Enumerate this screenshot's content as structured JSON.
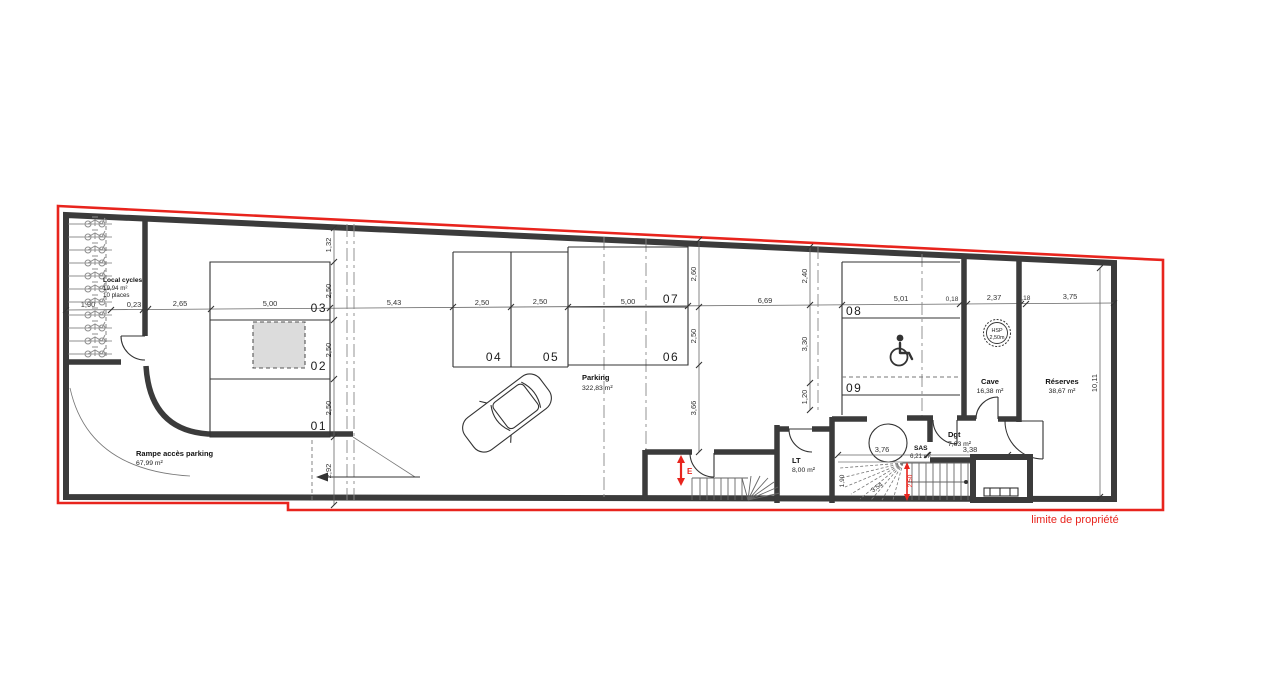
{
  "colors": {
    "wall": "#3b3b3b",
    "boundary": "#e8241d",
    "pillar": "#dcdcdc"
  },
  "boundary": {
    "label": "limite de propriété"
  },
  "markers": {
    "entrance": "E"
  },
  "hsp": {
    "line1": "HSP",
    "line2": "2,50m"
  },
  "rooms": {
    "local_cycles": {
      "name": "Local cycles",
      "area": "19,94 m²",
      "capacity": "10 places"
    },
    "parking": {
      "name": "Parking",
      "area": "322,83 m²"
    },
    "ramp": {
      "name": "Rampe accès parking",
      "area": "67,99 m²"
    },
    "lt": {
      "name": "LT",
      "area": "8,00 m²"
    },
    "sas": {
      "name": "SAS",
      "area": "6,21 m²"
    },
    "dgt": {
      "name": "Dgt",
      "area": "7,63 m²"
    },
    "cave": {
      "name": "Cave",
      "area": "16,38 m²"
    },
    "reserves": {
      "name": "Réserves",
      "area": "38,67 m²"
    }
  },
  "spots": {
    "s1": "01",
    "s2": "02",
    "s3": "03",
    "s4": "04",
    "s5": "05",
    "s6": "06",
    "s7": "07",
    "s8": "08",
    "s9": "09"
  },
  "dims": {
    "h": {
      "d190": "1,90",
      "d023": "0,23",
      "d265": "2,65",
      "d500a": "5,00",
      "d543": "5,43",
      "d250a": "2,50",
      "d250b": "2,50",
      "d500b": "5,00",
      "d669": "6,69",
      "d501": "5,01",
      "d018a": "0,18",
      "d237": "2,37",
      "d018b": "0,18",
      "d375": "3,75"
    },
    "v_left": {
      "d132": "1,32",
      "d250a": "2,50",
      "d250b": "2,50",
      "d250c": "2,50",
      "d292": "2,92"
    },
    "v_mid": {
      "d260": "2,60",
      "d250": "2,50",
      "d366": "3,66"
    },
    "v_right": {
      "d240": "2,40",
      "d330": "3,30",
      "d120": "1,20"
    },
    "v_far": {
      "d1011": "10,11"
    },
    "stairs": {
      "d376": "3,76",
      "d338": "3,38",
      "d190": "1,90",
      "d354": "3,54",
      "red": "2,50"
    }
  }
}
